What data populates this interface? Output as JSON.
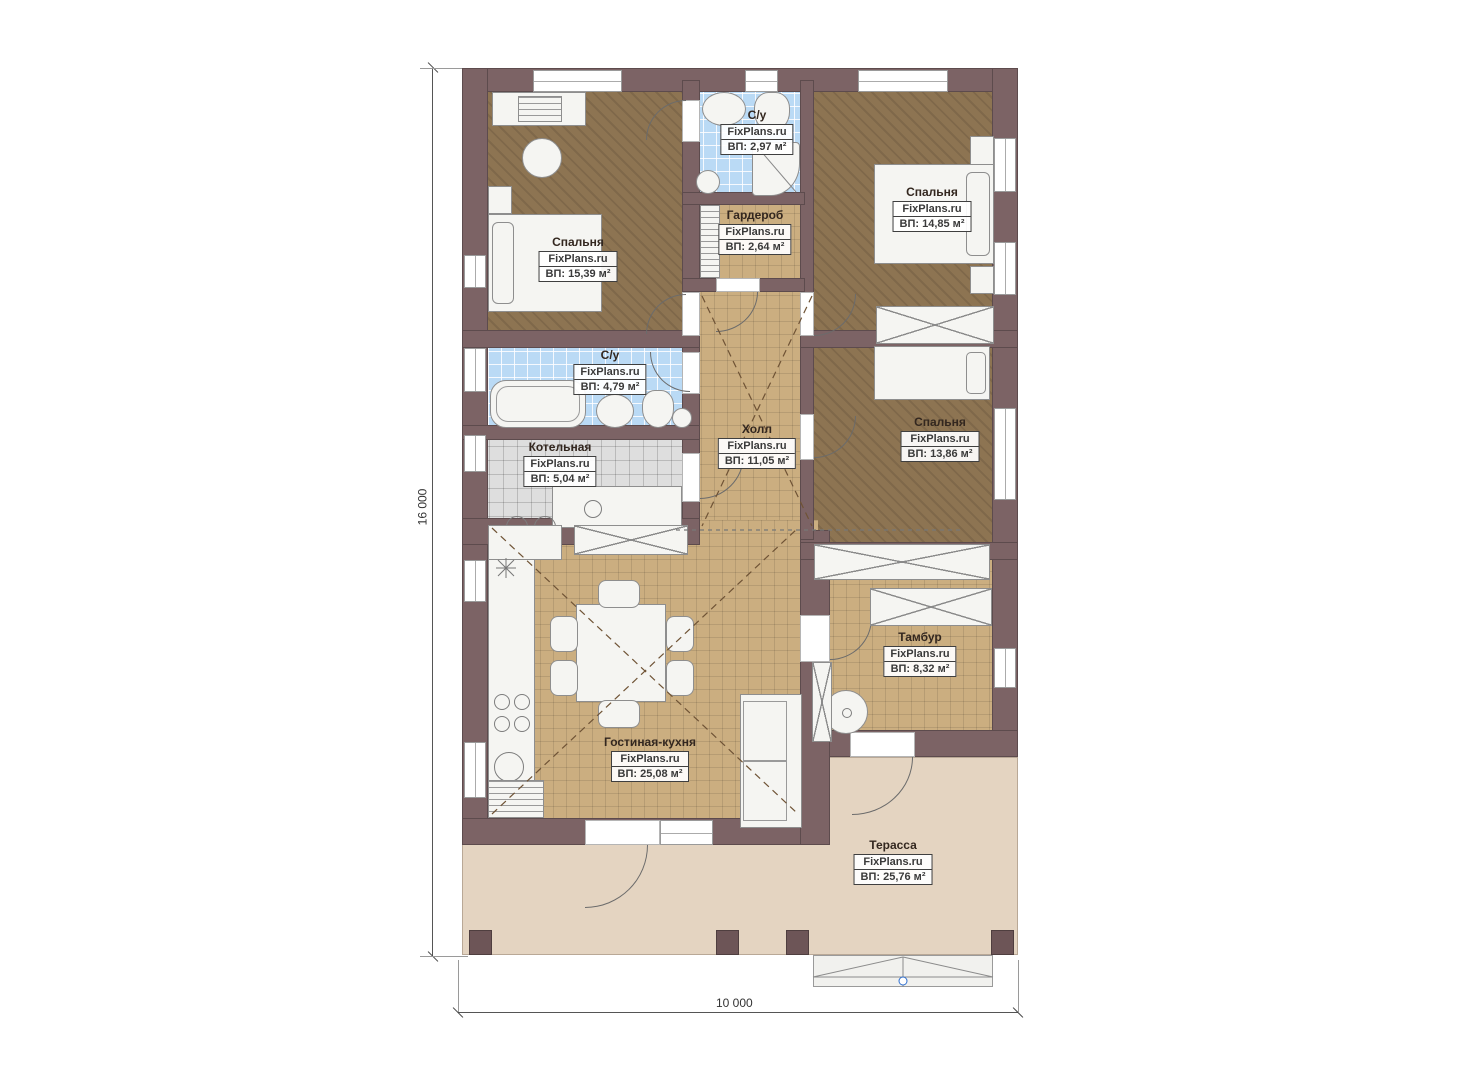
{
  "plan": {
    "title": "Floor plan",
    "brand": "FixPlans.ru",
    "dimension_left": "16 000",
    "dimension_bottom": "10 000"
  },
  "colors": {
    "wall": "#7c6365",
    "wood_floor": "#8d7452",
    "tile_floor": "#cbae80",
    "bath_tile": "#badaf5",
    "boiler_tile": "#dedede",
    "terrace": "#e4d4c1",
    "marker_blue": "#2f6fd0"
  },
  "rooms": [
    {
      "name": "Спальня",
      "brand": "FixPlans.ru",
      "area": "ВП: 15,39 м²"
    },
    {
      "name": "С/у",
      "brand": "FixPlans.ru",
      "area": "ВП: 2,97 м²"
    },
    {
      "name": "Гардероб",
      "brand": "FixPlans.ru",
      "area": "ВП: 2,64 м²"
    },
    {
      "name": "Спальня",
      "brand": "FixPlans.ru",
      "area": "ВП: 14,85 м²"
    },
    {
      "name": "С/у",
      "brand": "FixPlans.ru",
      "area": "ВП: 4,79 м²"
    },
    {
      "name": "Котельная",
      "brand": "FixPlans.ru",
      "area": "ВП: 5,04 м²"
    },
    {
      "name": "Холл",
      "brand": "FixPlans.ru",
      "area": "ВП: 11,05 м²"
    },
    {
      "name": "Спальня",
      "brand": "FixPlans.ru",
      "area": "ВП: 13,86 м²"
    },
    {
      "name": "Гостиная-кухня",
      "brand": "FixPlans.ru",
      "area": "ВП: 25,08 м²"
    },
    {
      "name": "Тамбур",
      "brand": "FixPlans.ru",
      "area": "ВП: 8,32 м²"
    },
    {
      "name": "Терасса",
      "brand": "FixPlans.ru",
      "area": "ВП: 25,76 м²"
    }
  ]
}
